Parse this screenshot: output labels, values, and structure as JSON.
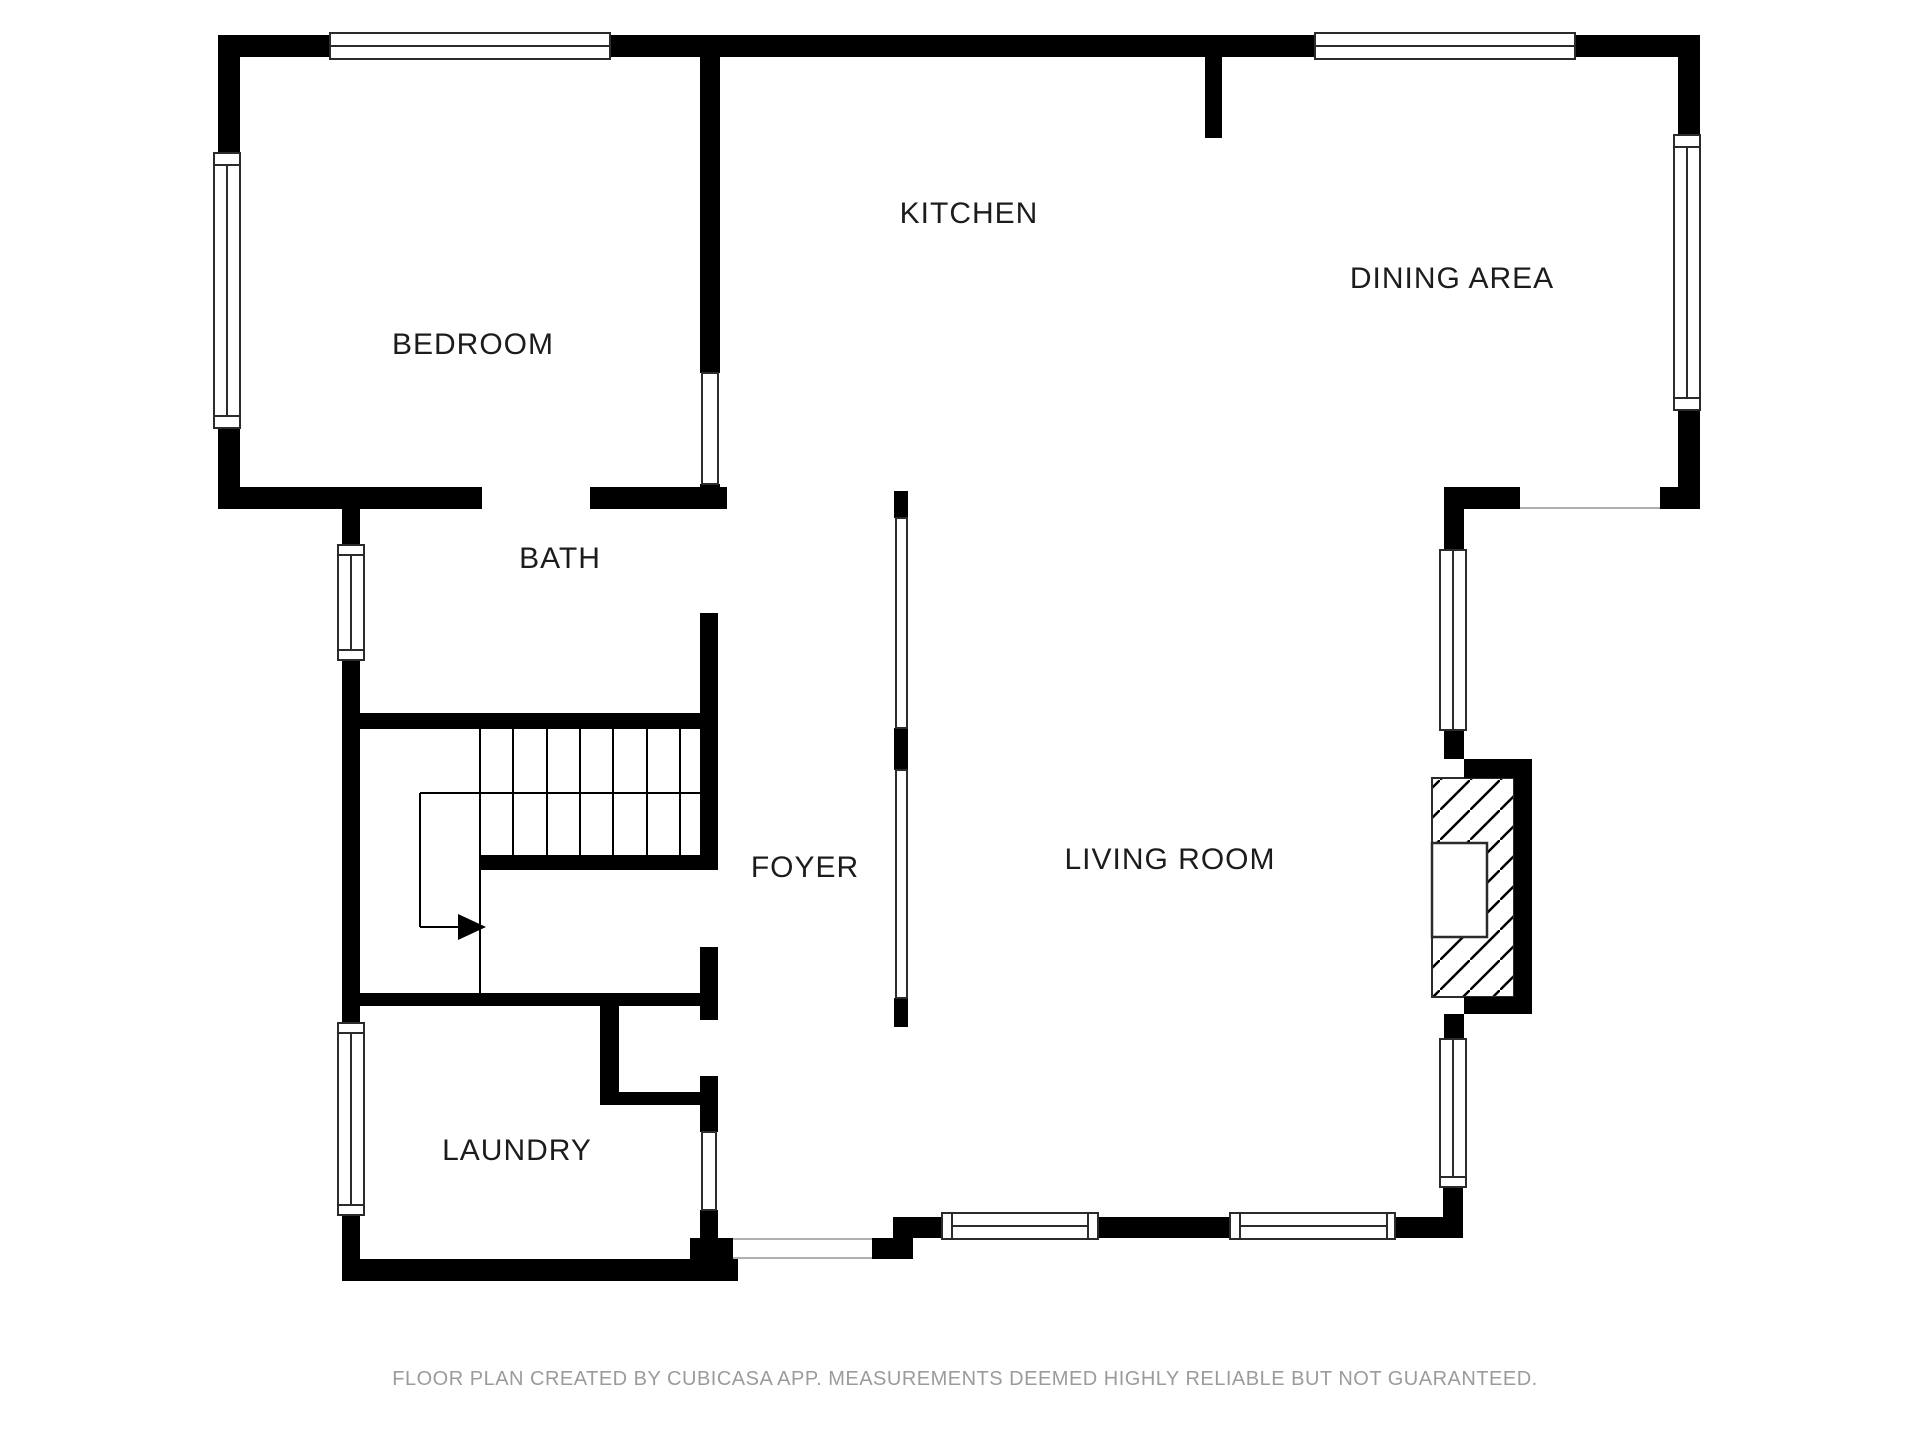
{
  "title": "Floor Plan",
  "colors": {
    "background": "#ffffff",
    "wall": "#000000",
    "glyph_outline": "#2b2b2b",
    "glyph_fill": "#ffffff",
    "stair_line": "#000000",
    "opening_line": "#b0b0b0",
    "label": "#1c1c1c",
    "footer": "#9b9b9b"
  },
  "rooms": [
    {
      "id": "bedroom",
      "label": "BEDROOM",
      "cx": 473,
      "cy": 346
    },
    {
      "id": "kitchen",
      "label": "KITCHEN",
      "cx": 969,
      "cy": 215
    },
    {
      "id": "dining-area",
      "label": "DINING AREA",
      "cx": 1452,
      "cy": 280
    },
    {
      "id": "bath",
      "label": "BATH",
      "cx": 560,
      "cy": 560
    },
    {
      "id": "foyer",
      "label": "FOYER",
      "cx": 805,
      "cy": 869
    },
    {
      "id": "living-room",
      "label": "LIVING ROOM",
      "cx": 1170,
      "cy": 861
    },
    {
      "id": "laundry",
      "label": "LAUNDRY",
      "cx": 517,
      "cy": 1152
    }
  ],
  "footer": {
    "text": "FLOOR PLAN CREATED BY CUBICASA APP. MEASUREMENTS DEEMED HIGHLY RELIABLE BUT NOT GUARANTEED.",
    "cx": 965,
    "cy": 1385
  },
  "geometry": {
    "canvas": {
      "w": 1920,
      "h": 1440
    },
    "walls": [
      [
        218,
        35,
        112,
        22
      ],
      [
        610,
        35,
        705,
        22
      ],
      [
        1575,
        35,
        125,
        22
      ],
      [
        218,
        35,
        22,
        118
      ],
      [
        218,
        428,
        22,
        81
      ],
      [
        218,
        487,
        264,
        22
      ],
      [
        590,
        487,
        137,
        22
      ],
      [
        342,
        487,
        18,
        58
      ],
      [
        342,
        660,
        18,
        363
      ],
      [
        342,
        1215,
        18,
        66
      ],
      [
        342,
        1259,
        396,
        22
      ],
      [
        690,
        1238,
        43,
        21
      ],
      [
        872,
        1238,
        41,
        21
      ],
      [
        893,
        1217,
        49,
        21
      ],
      [
        1098,
        1217,
        132,
        21
      ],
      [
        1395,
        1217,
        68,
        21
      ],
      [
        1443,
        1187,
        20,
        50
      ],
      [
        1444,
        1014,
        20,
        25
      ],
      [
        1444,
        509,
        20,
        41
      ],
      [
        1444,
        730,
        20,
        29
      ],
      [
        1444,
        487,
        76,
        22
      ],
      [
        1660,
        487,
        40,
        22
      ],
      [
        1678,
        35,
        22,
        100
      ],
      [
        1678,
        410,
        22,
        99
      ],
      [
        1205,
        55,
        17,
        83
      ],
      [
        700,
        35,
        20,
        338
      ],
      [
        700,
        484,
        20,
        25
      ],
      [
        700,
        613,
        18,
        257
      ],
      [
        700,
        947,
        18,
        73
      ],
      [
        700,
        1076,
        18,
        56
      ],
      [
        700,
        1210,
        18,
        48
      ],
      [
        350,
        713,
        368,
        16
      ],
      [
        480,
        855,
        238,
        15
      ],
      [
        350,
        993,
        368,
        13
      ],
      [
        600,
        993,
        19,
        112
      ],
      [
        600,
        1092,
        118,
        13
      ],
      [
        894,
        491,
        14,
        27
      ],
      [
        894,
        728,
        14,
        42
      ],
      [
        894,
        998,
        14,
        29
      ],
      [
        1464,
        759,
        68,
        19
      ],
      [
        1514,
        759,
        18,
        255
      ],
      [
        1464,
        997,
        68,
        17
      ]
    ],
    "window_glyphs": [
      {
        "x": 330,
        "y": 33,
        "w": 280,
        "h": 26,
        "mid": 1,
        "o": "h",
        "name": "window-bedroom-top"
      },
      {
        "x": 1315,
        "y": 33,
        "w": 260,
        "h": 26,
        "mid": 1,
        "o": "h",
        "name": "window-dining-top"
      },
      {
        "x": 214,
        "y": 165,
        "w": 26,
        "h": 251,
        "mid": 1,
        "o": "v",
        "name": "window-bedroom-left"
      },
      {
        "x": 338,
        "y": 555,
        "w": 26,
        "h": 95,
        "mid": 1,
        "o": "v",
        "name": "window-bath-left"
      },
      {
        "x": 338,
        "y": 1033,
        "w": 26,
        "h": 172,
        "mid": 1,
        "o": "v",
        "name": "window-laundry-left"
      },
      {
        "x": 1674,
        "y": 147,
        "w": 26,
        "h": 251,
        "mid": 1,
        "o": "v",
        "name": "window-dining-right"
      },
      {
        "x": 1440,
        "y": 550,
        "w": 26,
        "h": 180,
        "mid": 1,
        "o": "v",
        "name": "window-living-right-upper"
      },
      {
        "x": 1440,
        "y": 1039,
        "w": 26,
        "h": 138,
        "mid": 1,
        "o": "v",
        "name": "window-living-right-lower"
      },
      {
        "x": 952,
        "y": 1213,
        "w": 136,
        "h": 26,
        "mid": 1,
        "o": "h",
        "name": "window-living-bottom-1"
      },
      {
        "x": 1240,
        "y": 1213,
        "w": 147,
        "h": 26,
        "mid": 1,
        "o": "h",
        "name": "window-living-bottom-2"
      },
      {
        "x": 702,
        "y": 373,
        "w": 16,
        "h": 111,
        "mid": 0,
        "o": "v",
        "name": "interior-window-bedroom"
      },
      {
        "x": 896,
        "y": 518,
        "w": 11,
        "h": 210,
        "mid": 0,
        "o": "v",
        "name": "room-divider-upper"
      },
      {
        "x": 896,
        "y": 770,
        "w": 11,
        "h": 228,
        "mid": 0,
        "o": "v",
        "name": "room-divider-lower"
      },
      {
        "x": 702,
        "y": 1132,
        "w": 14,
        "h": 78,
        "mid": 0,
        "o": "v",
        "name": "interior-window-laundry"
      },
      {
        "x": 214,
        "y": 153,
        "w": 26,
        "h": 12,
        "mid": 0,
        "o": "v",
        "name": "window-sill"
      },
      {
        "x": 214,
        "y": 416,
        "w": 26,
        "h": 12,
        "mid": 0,
        "o": "v",
        "name": "window-sill"
      },
      {
        "x": 338,
        "y": 545,
        "w": 26,
        "h": 10,
        "mid": 0,
        "o": "v",
        "name": "window-sill"
      },
      {
        "x": 338,
        "y": 650,
        "w": 26,
        "h": 10,
        "mid": 0,
        "o": "v",
        "name": "window-sill"
      },
      {
        "x": 338,
        "y": 1023,
        "w": 26,
        "h": 10,
        "mid": 0,
        "o": "v",
        "name": "window-sill"
      },
      {
        "x": 338,
        "y": 1205,
        "w": 26,
        "h": 10,
        "mid": 0,
        "o": "v",
        "name": "window-sill"
      },
      {
        "x": 1674,
        "y": 135,
        "w": 26,
        "h": 12,
        "mid": 0,
        "o": "v",
        "name": "window-sill"
      },
      {
        "x": 1674,
        "y": 398,
        "w": 26,
        "h": 12,
        "mid": 0,
        "o": "v",
        "name": "window-sill"
      },
      {
        "x": 1440,
        "y": 1177,
        "w": 26,
        "h": 10,
        "mid": 0,
        "o": "v",
        "name": "window-sill"
      },
      {
        "x": 942,
        "y": 1213,
        "w": 10,
        "h": 26,
        "mid": 0,
        "o": "h",
        "name": "window-sill"
      },
      {
        "x": 1088,
        "y": 1213,
        "w": 10,
        "h": 26,
        "mid": 0,
        "o": "h",
        "name": "window-sill"
      },
      {
        "x": 1230,
        "y": 1213,
        "w": 10,
        "h": 26,
        "mid": 0,
        "o": "h",
        "name": "window-sill"
      },
      {
        "x": 1387,
        "y": 1213,
        "w": 8,
        "h": 26,
        "mid": 0,
        "o": "h",
        "name": "window-sill"
      }
    ],
    "lines": [
      {
        "x1": 480,
        "y1": 729,
        "x2": 480,
        "y2": 993,
        "w": 2,
        "c": "stair_line",
        "name": "stair-tread-line"
      },
      {
        "x1": 513,
        "y1": 729,
        "x2": 513,
        "y2": 855,
        "w": 2,
        "c": "stair_line",
        "name": "stair-tread-line"
      },
      {
        "x1": 547,
        "y1": 729,
        "x2": 547,
        "y2": 855,
        "w": 2,
        "c": "stair_line",
        "name": "stair-tread-line"
      },
      {
        "x1": 580,
        "y1": 729,
        "x2": 580,
        "y2": 855,
        "w": 2,
        "c": "stair_line",
        "name": "stair-tread-line"
      },
      {
        "x1": 613,
        "y1": 729,
        "x2": 613,
        "y2": 855,
        "w": 2,
        "c": "stair_line",
        "name": "stair-tread-line"
      },
      {
        "x1": 647,
        "y1": 729,
        "x2": 647,
        "y2": 855,
        "w": 2,
        "c": "stair_line",
        "name": "stair-tread-line"
      },
      {
        "x1": 680,
        "y1": 729,
        "x2": 680,
        "y2": 855,
        "w": 2,
        "c": "stair_line",
        "name": "stair-tread-line"
      },
      {
        "x1": 420,
        "y1": 793,
        "x2": 700,
        "y2": 793,
        "w": 2,
        "c": "stair_line",
        "name": "stair-mid-line"
      },
      {
        "x1": 420,
        "y1": 793,
        "x2": 420,
        "y2": 927,
        "w": 2,
        "c": "stair_line",
        "name": "stair-walk-line"
      },
      {
        "x1": 420,
        "y1": 927,
        "x2": 458,
        "y2": 927,
        "w": 2,
        "c": "stair_line",
        "name": "stair-walk-line"
      },
      {
        "x1": 733,
        "y1": 1239,
        "x2": 872,
        "y2": 1239,
        "w": 2,
        "c": "opening_line",
        "name": "entry-opening-line"
      },
      {
        "x1": 733,
        "y1": 1258,
        "x2": 872,
        "y2": 1258,
        "w": 2,
        "c": "opening_line",
        "name": "entry-opening-line"
      },
      {
        "x1": 1520,
        "y1": 508,
        "x2": 1660,
        "y2": 508,
        "w": 2,
        "c": "opening_line",
        "name": "dining-living-opening-line"
      }
    ],
    "stair_arrow": [
      [
        458,
        914
      ],
      [
        458,
        940
      ],
      [
        486,
        927
      ]
    ],
    "fireplace": {
      "hatch": {
        "x": 1432,
        "y": 778,
        "w": 82,
        "h": 219
      },
      "firebox": {
        "x": 1432,
        "y": 843,
        "w": 55,
        "h": 94
      },
      "hatch_spacing": 30
    }
  }
}
